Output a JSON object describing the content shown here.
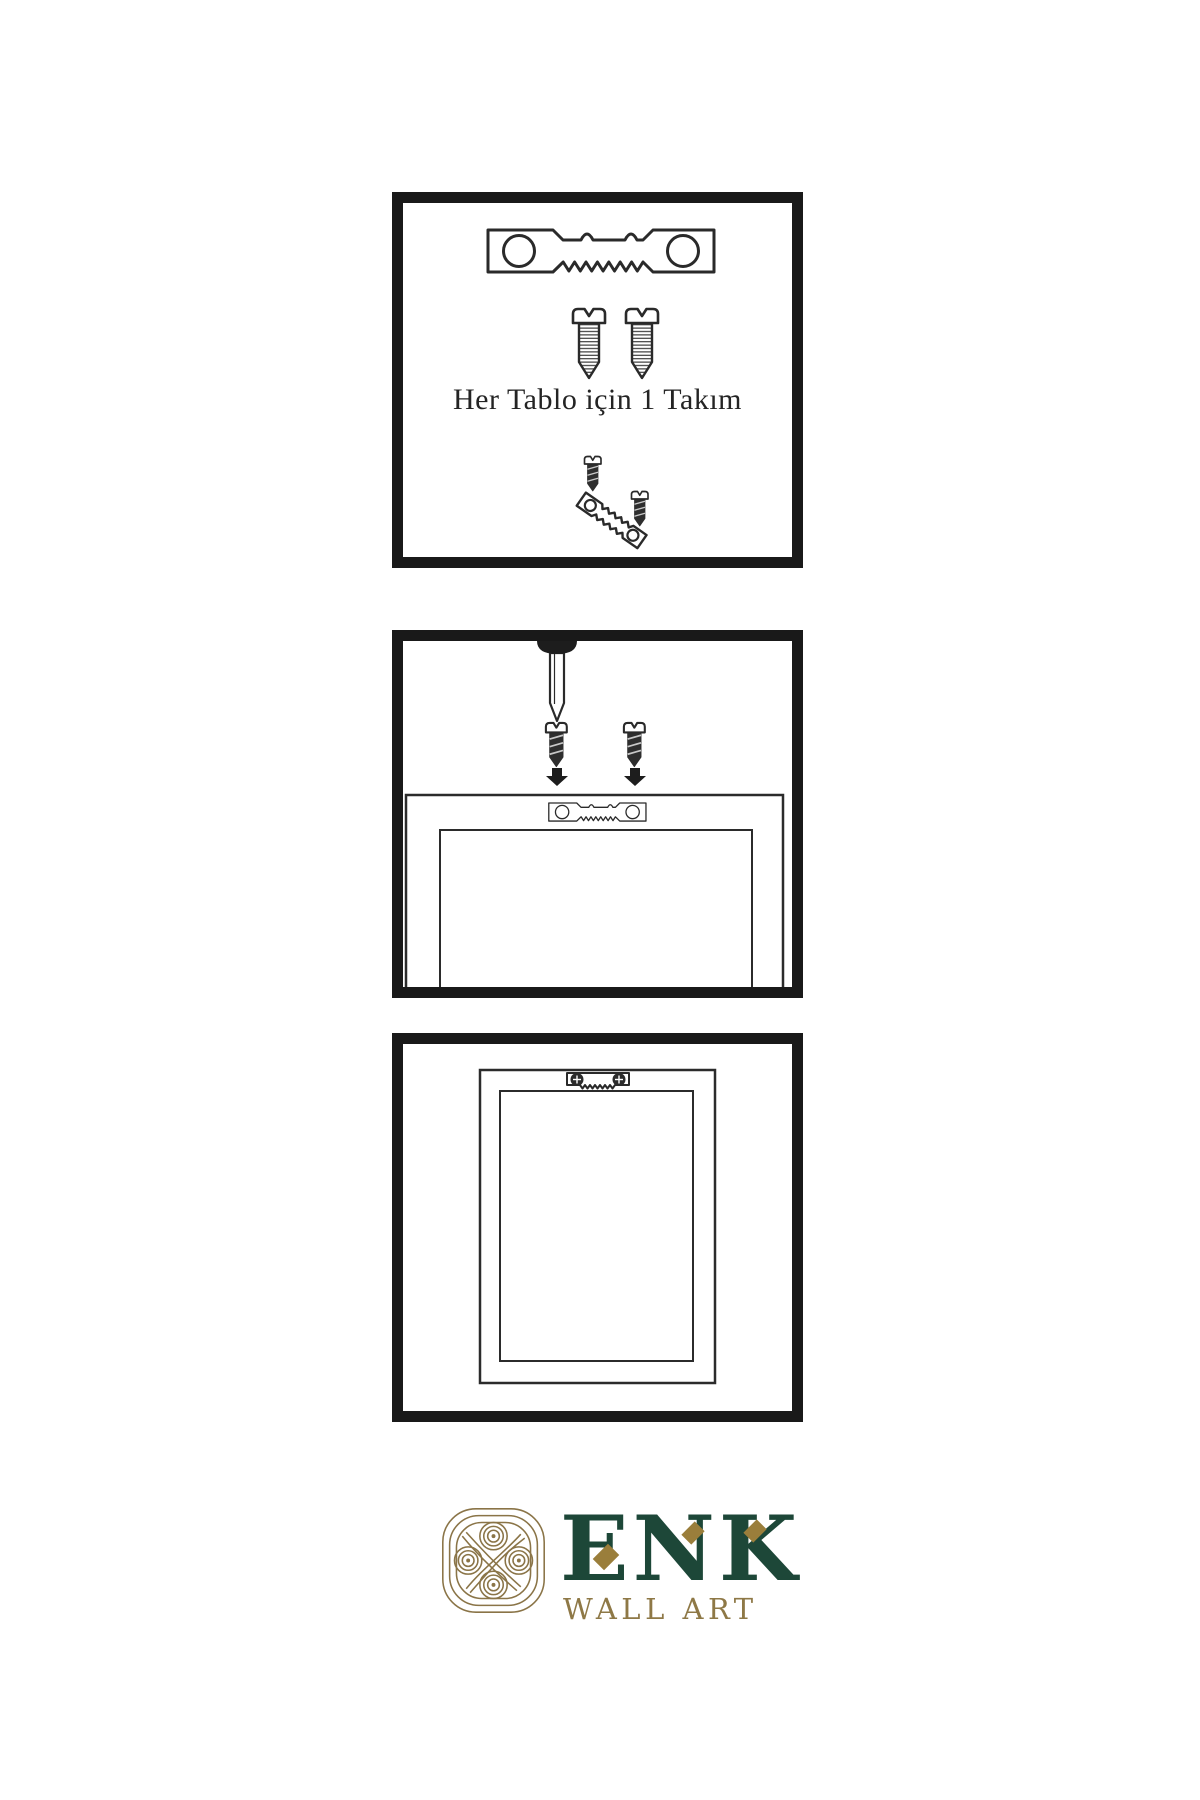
{
  "colors": {
    "background": "#ffffff",
    "panel_border": "#191919",
    "line_art": "#2a2a2a",
    "hardware_dark": "#2e2e2e",
    "brand_green": "#1d4738",
    "brand_gold": "#8e7846",
    "knot_gold": "#8a7447"
  },
  "panels": [
    {
      "name": "hardware-kit",
      "caption": "Her Tablo için 1 Takım",
      "items": [
        "sawtooth-hanger",
        "threaded-screw",
        "threaded-screw",
        "small-screw",
        "angled-sawtooth-hanger",
        "small-screw"
      ]
    },
    {
      "name": "mounting-step",
      "items": [
        "wall-nail",
        "small-screw",
        "small-screw",
        "down-arrow",
        "down-arrow",
        "frame-back",
        "sawtooth-hanger"
      ]
    },
    {
      "name": "hung-frame",
      "items": [
        "frame-outer",
        "frame-inner",
        "mounted-sawtooth-hanger"
      ]
    }
  ],
  "logo": {
    "brand": "ENK",
    "tagline": "WALL ART"
  }
}
